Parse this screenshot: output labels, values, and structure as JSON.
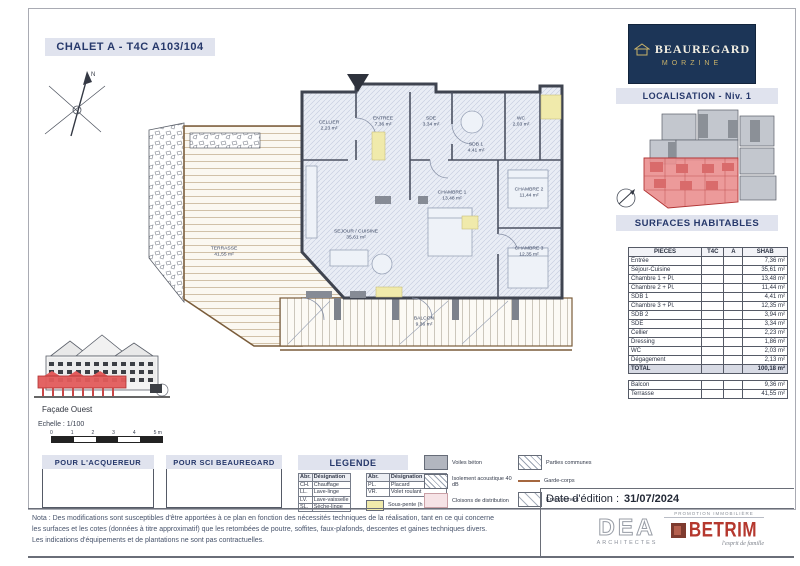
{
  "title": "CHALET A - T4C A103/104",
  "brand": {
    "name": "BEAUREGARD",
    "city": "MORZINE"
  },
  "localisation": {
    "header": "LOCALISATION - Niv. 1"
  },
  "surfaces": {
    "header": "SURFACES HABITABLES",
    "columns": [
      "PIECES",
      "T4C",
      "A",
      "SHAB"
    ],
    "rows": [
      [
        "Entrée",
        "7,36 m²"
      ],
      [
        "Séjour-Cuisine",
        "35,61 m²"
      ],
      [
        "Chambre 1 + Pl.",
        "13,48 m²"
      ],
      [
        "Chambre 2 + Pl.",
        "11,44 m²"
      ],
      [
        "SDB 1",
        "4,41 m²"
      ],
      [
        "Chambre 3 + Pl.",
        "12,35 m²"
      ],
      [
        "SDB 2",
        "3,94 m²"
      ],
      [
        "SDE",
        "3,34 m²"
      ],
      [
        "Cellier",
        "2,23 m²"
      ],
      [
        "Dressing",
        "1,86 m²"
      ],
      [
        "WC",
        "2,03 m²"
      ],
      [
        "Dégagement",
        "2,13 m²"
      ]
    ],
    "total": [
      "TOTAL",
      "100,18 m²"
    ],
    "annexes": [
      [
        "Balcon",
        "9,36 m²"
      ],
      [
        "Terrasse",
        "41,55 m²"
      ]
    ]
  },
  "plan": {
    "labels": [
      {
        "x": 329,
        "y": 126,
        "lines": [
          "CELLIER",
          "2,23 m²"
        ]
      },
      {
        "x": 383,
        "y": 122,
        "lines": [
          "ENTREE",
          "7,36 m²"
        ]
      },
      {
        "x": 431,
        "y": 122,
        "lines": [
          "SDE",
          "3,34 m²"
        ]
      },
      {
        "x": 476,
        "y": 148,
        "lines": [
          "SDB 1",
          "4,41 m²"
        ]
      },
      {
        "x": 521,
        "y": 122,
        "lines": [
          "WC",
          "2,03 m²"
        ]
      },
      {
        "x": 452,
        "y": 196,
        "lines": [
          "CHAMBRE 1",
          "13,48 m²"
        ]
      },
      {
        "x": 529,
        "y": 193,
        "lines": [
          "CHAMBRE 2",
          "11,44 m²"
        ]
      },
      {
        "x": 529,
        "y": 252,
        "lines": [
          "CHAMBRE 3",
          "12,35 m²"
        ]
      },
      {
        "x": 356,
        "y": 235,
        "lines": [
          "SEJOUR / CUISINE",
          "35,61 m²"
        ]
      },
      {
        "x": 224,
        "y": 252,
        "lines": [
          "TERRASSE",
          "41,55 m²"
        ]
      },
      {
        "x": 424,
        "y": 322,
        "lines": [
          "BALCON",
          "9,36 m²"
        ]
      }
    ]
  },
  "facade": {
    "label": "Façade Ouest"
  },
  "scalebar": {
    "label": "Echelle : 1/100",
    "ticks": [
      "0",
      "1",
      "2",
      "3",
      "4",
      "5 m"
    ]
  },
  "signatures": {
    "buyer": "POUR L'ACQUEREUR",
    "seller": "POUR SCI BEAUREGARD"
  },
  "legend": {
    "header": "LEGENDE",
    "abbr_header": [
      "Abr.",
      "Désignation"
    ],
    "abbr_left": [
      [
        "CH.",
        "Chauffage"
      ],
      [
        "LL.",
        "Lave-linge"
      ],
      [
        "LV.",
        "Lave-vaisselle"
      ],
      [
        "SL.",
        "Sèche-linge"
      ]
    ],
    "abbr_right": [
      [
        "PL.",
        "Placard"
      ],
      [
        "VR.",
        "Volet roulant"
      ]
    ],
    "yellow_label": "Sous-pente (h < 1,80 m)",
    "mid": [
      {
        "swatch": "gray",
        "label": "Voiles béton"
      },
      {
        "swatch": "crosshatch",
        "label": "Isolement acoustique 40 dB"
      },
      {
        "swatch": "pink",
        "label": "Cloisons de distribution"
      }
    ],
    "right": [
      {
        "swatch": "hatch",
        "label": "Parties communes"
      },
      {
        "swatch": "brownline",
        "label": "Garde-corps"
      },
      {
        "swatch": "sparse",
        "label": "Enrochement"
      }
    ]
  },
  "note_lines": [
    "Nota : Des modifications sont susceptibles d'être apportées à ce plan en fonction des nécessités techniques de la réalisation, tant en ce qui concerne",
    "les surfaces et les cotes (données à titre approximatif) que les retombées de poutre, soffites, faux-plafonds, descentes et gaines techniques divers.",
    "Les indications d'équipements et de plantations ne sont pas contractuelles."
  ],
  "edition": {
    "label": "Date d'édition :",
    "date": "31/07/2024"
  },
  "architect": {
    "name": "DEA",
    "subtitle": "ARCHITECTES"
  },
  "builder": {
    "top": "PROMOTION IMMOBILIÈRE",
    "name": "BETRIM",
    "tagline": "l'esprit de famille"
  },
  "colors": {
    "brand_navy": "#1c3557",
    "highlight_red": "#e25b5b",
    "accent_yellow": "#f0eaab",
    "bar_bg": "#e0e3ee"
  }
}
